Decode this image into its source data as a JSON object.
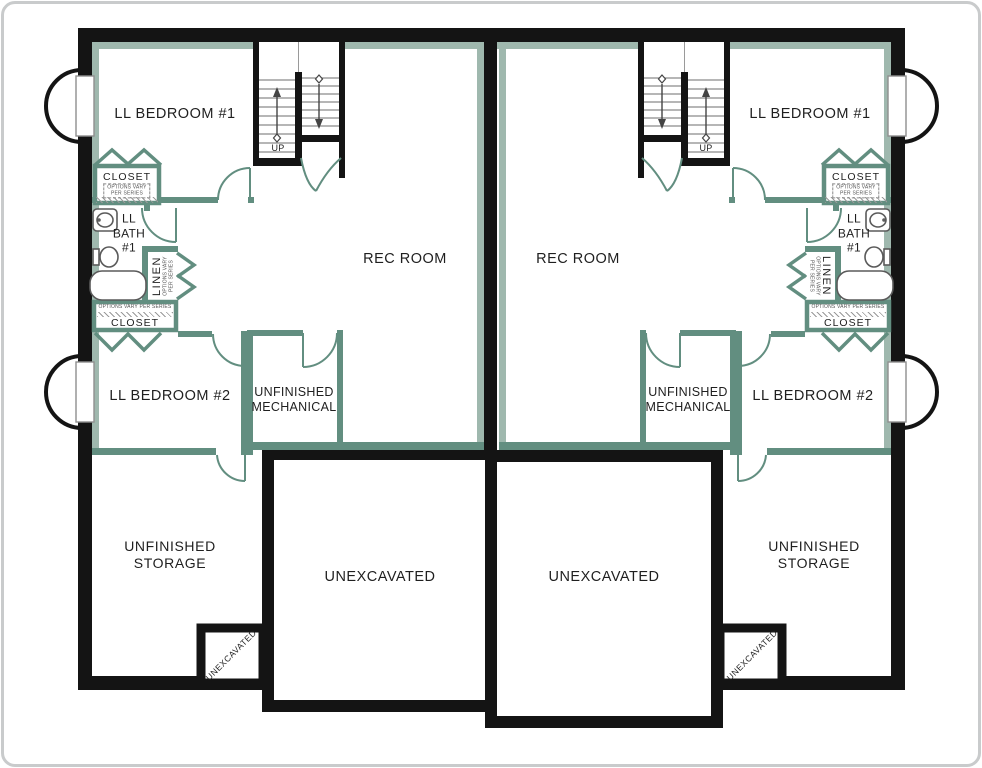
{
  "colors": {
    "wall_black": "#141414",
    "wall_finished": "#628E80",
    "wall_lining": "#9FB8AE",
    "text": "#1f1f1f",
    "frame": "#c9cbcc"
  },
  "labels": {
    "bedroom1": "LL BEDROOM #1",
    "bedroom2": "LL BEDROOM #2",
    "rec_room": "REC ROOM",
    "closet": "CLOSET",
    "linen": "LINEN",
    "bath_l1": "LL",
    "bath_l2": "BATH",
    "bath_l3": "#1",
    "options_l1": "OPTIONS VARY",
    "options_l2": "PER SERIES",
    "options_note": "OPTIONS VARY PER SERIES",
    "mech_l1": "UNFINISHED",
    "mech_l2": "MECHANICAL",
    "storage_l1": "UNFINISHED",
    "storage_l2": "STORAGE",
    "unexcavated": "UNEXCAVATED",
    "up": "UP"
  }
}
